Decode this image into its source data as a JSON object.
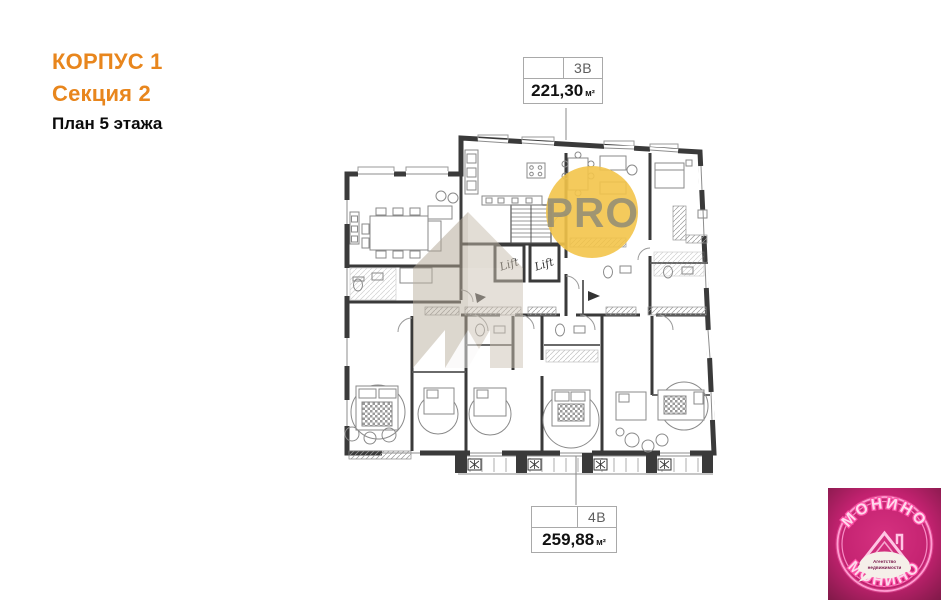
{
  "header": {
    "building": "КОРПУС 1",
    "section": "Секция 2",
    "floor": "План 5 этажа"
  },
  "units": {
    "top": {
      "code": "3В",
      "area": "221,30",
      "unit": "м²"
    },
    "bottom": {
      "code": "4В",
      "area": "259,88",
      "unit": "м²"
    }
  },
  "plan": {
    "lift_label": "Lift",
    "pro_watermark": "PRO"
  },
  "logo": {
    "brand_top": "МОНИНО",
    "brand_bottom": "МОНИНО",
    "tagline_line1": "Агентство",
    "tagline_line2": "недвижимости"
  },
  "colors": {
    "accent_orange": "#E8861D",
    "wall": "#3A3A3A",
    "furniture_line": "#8A8A8A",
    "pro_circle": "#F3C44A",
    "pro_text": "#8B8878",
    "watermark_taupe": "#C2B8A8",
    "logo_bg": "#C32270",
    "logo_neon": "#FF7CC0"
  }
}
